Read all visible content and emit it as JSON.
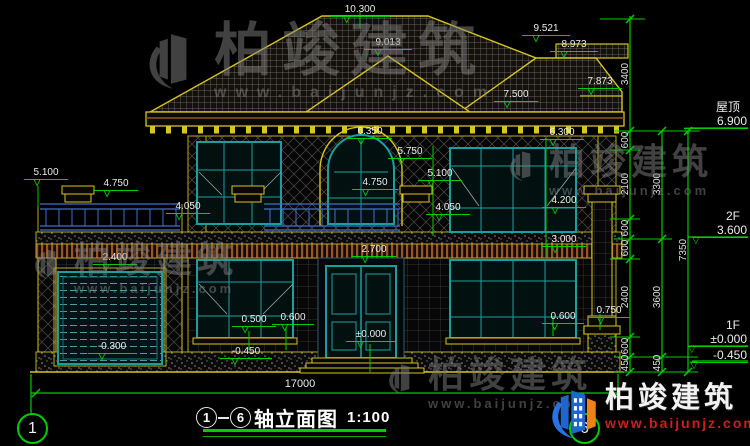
{
  "watermark": {
    "brand": "柏竣建筑",
    "url": "www.baijunjz.com"
  },
  "title_block": {
    "axis_start": "1",
    "axis_end": "6",
    "name": "轴立面图",
    "scale": "1:100",
    "total_width": "17000"
  },
  "levels": {
    "roof_name": "屋顶",
    "roof_value": "6.900",
    "f2_name": "2F",
    "f2_value": "3.600",
    "f1_name": "1F",
    "f1_value": "±0.000",
    "ground_value": "-0.450"
  },
  "vdims": {
    "a": [
      "3400",
      "600",
      "2100",
      "600",
      "600",
      "2400",
      "600",
      "450"
    ],
    "b": [
      "3300",
      "3600",
      "450"
    ],
    "c": [
      "7350"
    ]
  },
  "marks": [
    "10.300",
    "9.013",
    "9.521",
    "8.973",
    "7.873",
    "7.500",
    "6.350",
    "6.300",
    "5.750",
    "5.100",
    "4.750",
    "4.050",
    "4.200",
    "3.000",
    "5.100",
    "4.750",
    "4.050",
    "2.400",
    "2.700",
    "0.500",
    "0.600",
    "0.600",
    "0.750",
    "±0.000",
    "-0.300",
    "-0.450"
  ]
}
